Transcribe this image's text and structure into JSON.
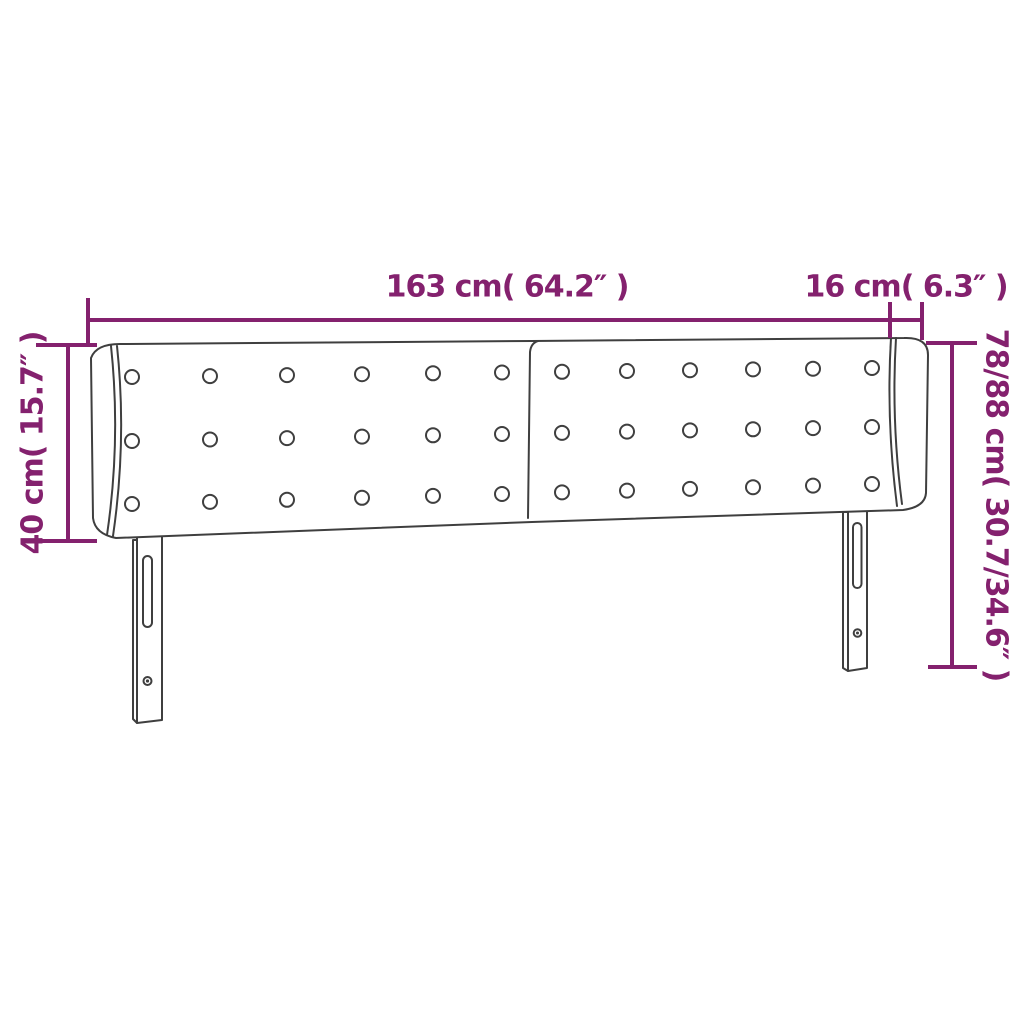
{
  "diagram": {
    "type": "product-dimension-diagram",
    "subject": "upholstered headboard with wings and adjustable legs",
    "colors": {
      "dimension": "#84216e",
      "outline": "#3f3f3f",
      "background": "#ffffff"
    },
    "labels": {
      "width_main": "163 cm( 64.2″ )",
      "width_wing": "16 cm( 6.3″ )",
      "height_upholstered": "40 cm( 15.7″ )",
      "height_total": "78/88 cm( 30.7/34.6″ )"
    },
    "buttons": {
      "radius": 7,
      "x_positions": [
        132,
        210,
        287,
        362,
        433,
        502,
        562,
        627,
        690,
        753,
        813,
        872
      ],
      "x_left": 132,
      "x_right": 872,
      "rows": [
        {
          "y_at_left": 377,
          "y_at_right": 368
        },
        {
          "y_at_left": 441,
          "y_at_right": 427
        },
        {
          "y_at_left": 504,
          "y_at_right": 484
        }
      ]
    }
  }
}
